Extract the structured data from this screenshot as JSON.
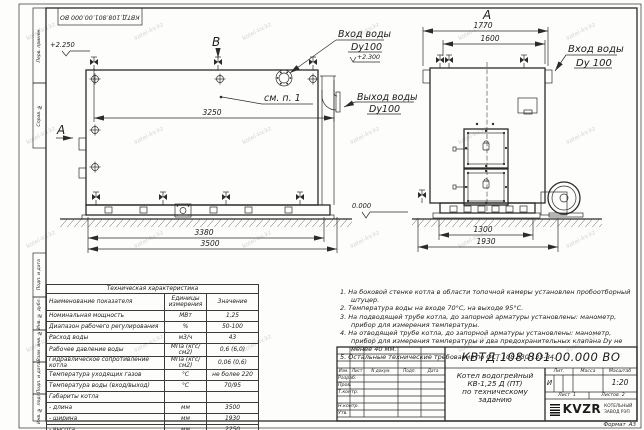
{
  "stamp_top": "КВТД.108.801.00.000 ВО",
  "frame_labels": [
    "Перв. примен.",
    "Справ. №",
    "Подп. и дата",
    "Инв. № дубл.",
    "Взам. инв. №",
    "Подп. и дата",
    "Инв. № подл."
  ],
  "side_view": {
    "view_b": "В",
    "section_a": "А",
    "level_top": "+2.250",
    "level_inlet": "+2.300",
    "see_note": "см. п. 1",
    "dim_top": "3250",
    "dim_base": "3380",
    "dim_overall": "3500",
    "inlet_label": "Вход воды",
    "inlet_dn": "Dy100",
    "outlet_label": "Выход воды",
    "outlet_dn": "Dy100"
  },
  "front_view": {
    "view_label": "А",
    "dim_overall": "1770",
    "dim_inner": "1600",
    "dim_base": "1300",
    "dim_width": "1930",
    "inlet_label": "Вход воды",
    "inlet_dn": "Dy 100",
    "level_zero": "0.000"
  },
  "spec_table": {
    "title": "Техническая характеристика",
    "headers": [
      "Наименование показателя",
      "Единицы измерения",
      "Значение"
    ],
    "rows": [
      [
        "Номинальная мощность",
        "МВт",
        "1,25"
      ],
      [
        "Диапазон рабочего регулирования",
        "%",
        "50-100"
      ],
      [
        "Расход воды",
        "м3/ч",
        "43"
      ],
      [
        "Рабочее давление воды",
        "МПа (кгс/см2)",
        "0,6 (6,0)"
      ],
      [
        "Гидравлическое сопротивление котла",
        "МПа (кгс/см2)",
        "0,06 (0,6)"
      ],
      [
        "Температура уходящих газов",
        "°С",
        "не более 220"
      ],
      [
        "Температура воды (вход/выход)",
        "°С",
        "70/95"
      ],
      [
        "Габариты котла",
        "",
        ""
      ],
      [
        "- длина",
        "мм",
        "3500"
      ],
      [
        "- ширина",
        "мм",
        "1930"
      ],
      [
        "- высота",
        "мм",
        "2250"
      ]
    ]
  },
  "notes": [
    "1. На боковой стенке котла в области топочной камеры установлен пробоотборный штуцер.",
    "2. Температура воды на входе 70°С, на выходе 95°С.",
    "3. На подводящей трубе котла, до запорной арматуры установлены: манометр, прибор для измерения температуры.",
    "4. На отводящей трубе котла, до запорной арматуры установлены: манометр, прибор для измерения температуры и два предохранительных клапана Dу не менее 40 мм.",
    "5. Остальные технические требования по ОСТ 108.030.133-84."
  ],
  "title_block": {
    "doc_number": "КВТД.108.801.00.000  ВО",
    "description_line1": "Котел водогрейный",
    "description_line2": "КВ-1,25 Д (ПТ)",
    "description_line3": "по техническому заданию",
    "col_headers": [
      "Изм.",
      "Лист",
      "N докум.",
      "Подп.",
      "Дата"
    ],
    "row_labels": [
      "Разраб.",
      "Пров.",
      "Т.контр.",
      "Н.контр.",
      "Утв."
    ],
    "lit_header": "Лит.",
    "lit_value": "И",
    "mass_header": "Масса",
    "scale_header": "Масштаб",
    "scale_value": "1:20",
    "sheet_label": "Лист",
    "sheet_value": "1",
    "sheets_label": "Листов",
    "sheets_value": "2",
    "logo_text": "KVZR",
    "logo_caption_line1": "КОТЕЛЬНЫЙ",
    "logo_caption_line2": "ЗАВОД РЭП",
    "format_label": "Формат",
    "format_value": "А3"
  },
  "watermark": "kotel-kv.kz"
}
